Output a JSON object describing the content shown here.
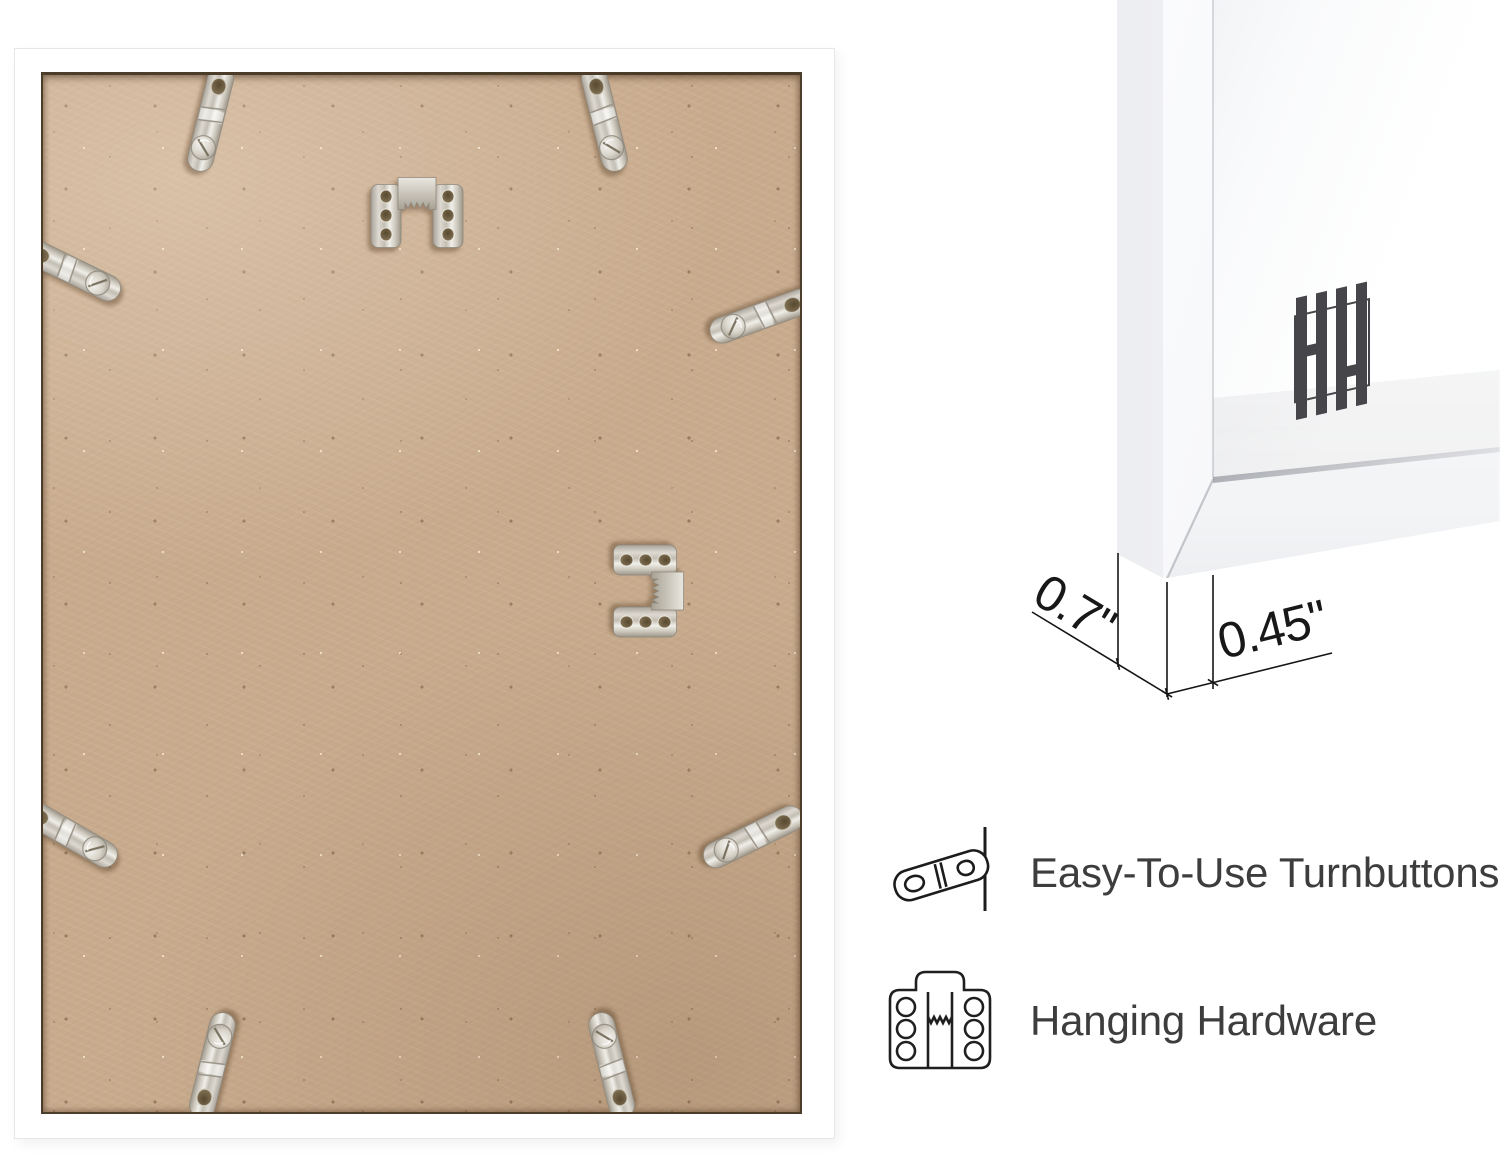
{
  "page": {
    "background": "#ffffff"
  },
  "colors": {
    "backing_mdf": "#c8ab8d",
    "frame_white": "#ffffff",
    "metal_silver": "#d6d2c9",
    "annotation_line": "#151515",
    "label_text": "#3d3d3d",
    "logo_gray": "#46464a"
  },
  "dimension_callout": {
    "depth": "0.7\"",
    "face_width": "0.45\""
  },
  "features": {
    "items": [
      {
        "icon": "turnbutton-icon",
        "label": "Easy-To-Use Turnbuttons"
      },
      {
        "icon": "hanging-hardware-icon",
        "label": "Hanging Hardware"
      }
    ]
  },
  "back_photo": {
    "subject": "frame-back-with-hardware",
    "turnbuttons": [
      {
        "x": 167,
        "y": 46,
        "rot": 14
      },
      {
        "x": 562,
        "y": 46,
        "rot": -14
      },
      {
        "x": 30,
        "y": 196,
        "rot": -64
      },
      {
        "x": 716,
        "y": 242,
        "rot": 70
      },
      {
        "x": 28,
        "y": 760,
        "rot": -60
      },
      {
        "x": 708,
        "y": 763,
        "rot": 64
      },
      {
        "x": 170,
        "y": 988,
        "rot": 194
      },
      {
        "x": 568,
        "y": 988,
        "rot": 166
      }
    ],
    "sawtooth_hangers": [
      {
        "x": 374,
        "y": 140,
        "rot": 0
      },
      {
        "x": 603,
        "y": 516,
        "rot": 90
      }
    ]
  },
  "closeup_photo": {
    "subject": "frame-corner-profile",
    "logo": "hh-monogram"
  }
}
